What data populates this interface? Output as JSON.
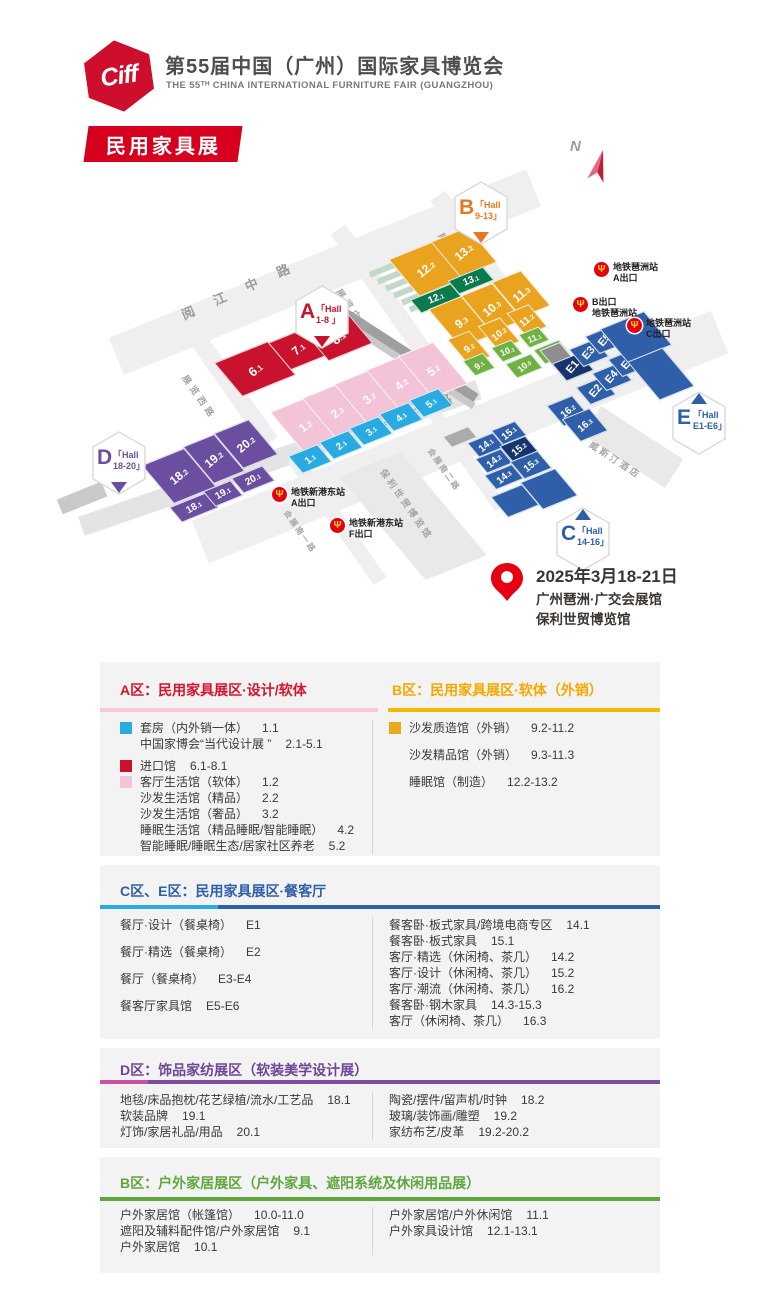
{
  "header": {
    "logo": "Ciff",
    "title": "第55届中国（广州）国际家具博览会",
    "subtitle": "THE 55ᵀᴴ CHINA INTERNATIONAL FURNITURE FAIR (GUANGZHOU)",
    "badge": "民用家具展"
  },
  "map": {
    "north": "N",
    "palette": {
      "yellow": "#E9A31F",
      "dgreen": "#0B7A4D",
      "green": "#6FB145",
      "red": "#C9132E",
      "pink": "#F3C3D8",
      "cyan": "#29ABE2",
      "blue": "#2E5FA8",
      "navy": "#16356F",
      "purple": "#6C4EA1",
      "gray": "#8E8E8E",
      "gray2": "#ABABAB"
    },
    "roads": [
      {
        "x": 100,
        "y": 252,
        "w": 450,
        "h": 40,
        "rot": -22,
        "c": "#EFEFEF"
      },
      {
        "x": 180,
        "y": 414,
        "w": 560,
        "h": 46,
        "rot": -22,
        "c": "#EFEFEF"
      },
      {
        "x": 70,
        "y": 448,
        "w": 420,
        "h": 20,
        "rot": -19,
        "c": "#E4E4E4"
      },
      {
        "x": 168,
        "y": 380,
        "w": 130,
        "h": 18,
        "rot": 55,
        "c": "#EFEFEF"
      },
      {
        "x": 306,
        "y": 282,
        "w": 150,
        "h": 18,
        "rot": 55,
        "c": "#EFEFEF"
      },
      {
        "x": 410,
        "y": 240,
        "w": 130,
        "h": 18,
        "rot": 55,
        "c": "#EFEFEF"
      },
      {
        "x": 406,
        "y": 452,
        "w": 120,
        "h": 13,
        "rot": 55,
        "c": "#EFEFEF"
      },
      {
        "x": 262,
        "y": 512,
        "w": 150,
        "h": 15,
        "rot": 55,
        "c": "#EFEFEF"
      },
      {
        "x": 330,
        "y": 350,
        "w": 158,
        "h": 12,
        "rot": 33,
        "c": "#9F9F9F"
      },
      {
        "x": 336,
        "y": 362,
        "w": 150,
        "h": 7,
        "rot": 33,
        "c": "#C9C9C9"
      },
      {
        "x": 380,
        "y": 452,
        "w": 66,
        "h": 128,
        "rot": -22,
        "skew": 18,
        "c": "#E9E9E7"
      },
      {
        "x": 584,
        "y": 430,
        "w": 98,
        "h": 34,
        "rot": 33,
        "c": "#E9E9E7"
      },
      {
        "x": 58,
        "y": 490,
        "w": 48,
        "h": 16,
        "rot": -22,
        "c": "#C9C9C9"
      }
    ],
    "stairs": {
      "x": 368,
      "y": 262,
      "n": 6,
      "dx": 8,
      "dy": 7,
      "w": 52,
      "h": 6,
      "c": "#C3D9C7",
      "rot": -22
    },
    "road_labels": [
      {
        "t": "阅 江 中 路",
        "x": 178,
        "y": 306,
        "rot": -24,
        "fs": 13,
        "sp": 9,
        "c": "#9B9B9B"
      },
      {
        "t": "新 港 东 路",
        "x": 340,
        "y": 436,
        "rot": -24,
        "fs": 13,
        "sp": 9,
        "c": "#9B9B9B"
      },
      {
        "t": "展览东路",
        "x": 446,
        "y": 230,
        "rot": 55,
        "fs": 9,
        "sp": 4,
        "c": "#A5A5A5"
      },
      {
        "t": "展览中路",
        "x": 344,
        "y": 286,
        "rot": 55,
        "fs": 9,
        "sp": 4,
        "c": "#A5A5A5"
      },
      {
        "t": "展览西路",
        "x": 190,
        "y": 372,
        "rot": 55,
        "fs": 9,
        "sp": 4,
        "c": "#A5A5A5"
      },
      {
        "t": "会展南二路",
        "x": 434,
        "y": 446,
        "rot": 55,
        "fs": 8,
        "sp": 2,
        "c": "#A5A5A5"
      },
      {
        "t": "会展南一路",
        "x": 290,
        "y": 508,
        "rot": 55,
        "fs": 8,
        "sp": 2,
        "c": "#A5A5A5"
      },
      {
        "t": "威斯汀酒店",
        "x": 594,
        "y": 438,
        "rot": 33,
        "fs": 9,
        "sp": 3,
        "c": "#A5A5A5"
      },
      {
        "t": "保利世贸博览馆",
        "x": 388,
        "y": 466,
        "rot": 55,
        "fs": 9,
        "sp": 3,
        "c": "#A5A5A5"
      }
    ],
    "halls": [
      {
        "t": "12.2",
        "c": "yellow",
        "x": 402,
        "y": 246,
        "w": 46,
        "h": 44
      },
      {
        "t": "13.2",
        "c": "yellow",
        "x": 444,
        "y": 230,
        "w": 38,
        "h": 42
      },
      {
        "t": "12.1",
        "c": "dgreen",
        "x": 414,
        "y": 290,
        "w": 42,
        "h": 15,
        "tr": -22,
        "fs": 10
      },
      {
        "t": "13.1",
        "c": "dgreen",
        "x": 452,
        "y": 272,
        "w": 36,
        "h": 15,
        "tr": -22,
        "fs": 10
      },
      {
        "t": "9.3",
        "c": "yellow",
        "x": 443,
        "y": 298,
        "w": 34,
        "h": 46
      },
      {
        "t": "10.3",
        "c": "yellow",
        "x": 475,
        "y": 285,
        "w": 32,
        "h": 44
      },
      {
        "t": "11.3",
        "c": "yellow",
        "x": 505,
        "y": 272,
        "w": 30,
        "h": 42
      },
      {
        "t": "9.2",
        "c": "yellow",
        "x": 457,
        "y": 332,
        "w": 22,
        "h": 30,
        "fs": 10
      },
      {
        "t": "10.2",
        "c": "yellow",
        "x": 487,
        "y": 319,
        "w": 22,
        "h": 28,
        "fs": 10
      },
      {
        "t": "11.2",
        "c": "yellow",
        "x": 515,
        "y": 306,
        "w": 22,
        "h": 26,
        "fs": 10
      },
      {
        "t": "9.1",
        "c": "green",
        "x": 468,
        "y": 355,
        "w": 20,
        "h": 17,
        "fs": 9
      },
      {
        "t": "10.1",
        "c": "green",
        "x": 496,
        "y": 342,
        "w": 20,
        "h": 16,
        "fs": 9,
        "tr": -22
      },
      {
        "t": "11.1",
        "c": "green",
        "x": 523,
        "y": 329,
        "w": 20,
        "h": 15,
        "fs": 9,
        "tr": -22
      },
      {
        "t": "10.0",
        "c": "green",
        "x": 510,
        "y": 357,
        "w": 26,
        "h": 16,
        "fs": 9
      },
      {
        "t": "11.0",
        "c": "green",
        "x": 538,
        "y": 343,
        "w": 26,
        "h": 16,
        "fs": 9
      },
      {
        "t": "6.1",
        "c": "red",
        "x": 226,
        "y": 348,
        "w": 56,
        "h": 40,
        "fs": 13
      },
      {
        "t": "7.1",
        "c": "red",
        "x": 278,
        "y": 332,
        "w": 38,
        "h": 32,
        "fs": 12
      },
      {
        "t": "8.1",
        "c": "red",
        "x": 314,
        "y": 318,
        "w": 46,
        "h": 36,
        "fs": 13
      },
      {
        "t": "1.2",
        "c": "pink",
        "x": 286,
        "y": 400,
        "w": 36,
        "h": 50
      },
      {
        "t": "2.2",
        "c": "pink",
        "x": 318,
        "y": 386,
        "w": 36,
        "h": 50
      },
      {
        "t": "3.2",
        "c": "pink",
        "x": 350,
        "y": 372,
        "w": 36,
        "h": 50
      },
      {
        "t": "4.2",
        "c": "pink",
        "x": 382,
        "y": 358,
        "w": 36,
        "h": 50
      },
      {
        "t": "5.2",
        "c": "pink",
        "x": 414,
        "y": 344,
        "w": 36,
        "h": 50
      },
      {
        "t": "1.1",
        "c": "cyan",
        "x": 294,
        "y": 448,
        "w": 30,
        "h": 20,
        "fs": 10
      },
      {
        "t": "2.1",
        "c": "cyan",
        "x": 325,
        "y": 434,
        "w": 30,
        "h": 20,
        "fs": 10
      },
      {
        "t": "3.1",
        "c": "cyan",
        "x": 355,
        "y": 420,
        "w": 30,
        "h": 20,
        "fs": 10
      },
      {
        "t": "4.1",
        "c": "cyan",
        "x": 385,
        "y": 406,
        "w": 30,
        "h": 20,
        "fs": 10
      },
      {
        "t": "5.1",
        "c": "cyan",
        "x": 415,
        "y": 392,
        "w": 30,
        "h": 20,
        "fs": 10
      },
      {
        "t": "18.2",
        "c": "purple",
        "x": 156,
        "y": 452,
        "w": 44,
        "h": 46
      },
      {
        "t": "19.2",
        "c": "purple",
        "x": 197,
        "y": 436,
        "w": 32,
        "h": 44
      },
      {
        "t": "20.2",
        "c": "purple",
        "x": 227,
        "y": 422,
        "w": 36,
        "h": 42
      },
      {
        "t": "18.1",
        "c": "purple",
        "x": 174,
        "y": 498,
        "w": 38,
        "h": 17,
        "tr": -30,
        "fs": 10
      },
      {
        "t": "19.1",
        "c": "purple",
        "x": 208,
        "y": 484,
        "w": 28,
        "h": 17,
        "tr": -30,
        "fs": 10
      },
      {
        "t": "20.1",
        "c": "purple",
        "x": 236,
        "y": 470,
        "w": 32,
        "h": 17,
        "tr": -30,
        "fs": 10
      },
      {
        "t": "",
        "c": "gray",
        "x": 546,
        "y": 344,
        "w": 20,
        "h": 20
      },
      {
        "t": "",
        "c": "gray2",
        "x": 446,
        "y": 430,
        "w": 26,
        "h": 12
      },
      {
        "t": "E1",
        "c": "navy",
        "x": 558,
        "y": 356,
        "w": 28,
        "h": 20,
        "tr": -50,
        "fs": 11
      },
      {
        "t": "E3",
        "c": "blue",
        "x": 575,
        "y": 342,
        "w": 26,
        "h": 20,
        "tr": -50,
        "fs": 11
      },
      {
        "t": "E5",
        "c": "blue",
        "x": 591,
        "y": 329,
        "w": 26,
        "h": 20,
        "tr": -50,
        "fs": 11
      },
      {
        "t": "E2",
        "c": "blue",
        "x": 582,
        "y": 380,
        "w": 26,
        "h": 20,
        "tr": -50,
        "fs": 11
      },
      {
        "t": "E4",
        "c": "blue",
        "x": 598,
        "y": 366,
        "w": 26,
        "h": 20,
        "tr": -50,
        "fs": 11
      },
      {
        "t": "E6",
        "c": "blue",
        "x": 614,
        "y": 352,
        "w": 26,
        "h": 20,
        "tr": -50,
        "fs": 11
      },
      {
        "t": "",
        "c": "blue",
        "x": 612,
        "y": 316,
        "w": 46,
        "h": 40
      },
      {
        "t": "",
        "c": "blue",
        "x": 642,
        "y": 350,
        "w": 36,
        "h": 46
      },
      {
        "t": "16.2",
        "c": "blue",
        "x": 554,
        "y": 398,
        "w": 26,
        "h": 24,
        "fs": 10
      },
      {
        "t": "16.3",
        "c": "blue",
        "x": 570,
        "y": 411,
        "w": 28,
        "h": 26,
        "fs": 10
      },
      {
        "t": "14.1",
        "c": "blue",
        "x": 472,
        "y": 436,
        "w": 26,
        "h": 16,
        "fs": 10
      },
      {
        "t": "15.1",
        "c": "blue",
        "x": 496,
        "y": 424,
        "w": 24,
        "h": 16,
        "fs": 10
      },
      {
        "t": "14.2",
        "c": "blue",
        "x": 480,
        "y": 452,
        "w": 26,
        "h": 16,
        "fs": 10
      },
      {
        "t": "15.2",
        "c": "navy",
        "x": 505,
        "y": 439,
        "w": 26,
        "h": 18,
        "fs": 10
      },
      {
        "t": "14.3",
        "c": "blue",
        "x": 489,
        "y": 468,
        "w": 28,
        "h": 16,
        "fs": 10
      },
      {
        "t": "15.3",
        "c": "blue",
        "x": 516,
        "y": 454,
        "w": 28,
        "h": 20,
        "fs": 10
      },
      {
        "t": "",
        "c": "blue",
        "x": 498,
        "y": 488,
        "w": 32,
        "h": 24
      },
      {
        "t": "",
        "c": "blue",
        "x": 530,
        "y": 472,
        "w": 36,
        "h": 32
      }
    ],
    "badges": [
      {
        "letter": "B",
        "l1": "「Hall",
        "l2": "9-13」",
        "c": "#E87722",
        "x": 452,
        "y": 180,
        "tri": "bottom"
      },
      {
        "letter": "A",
        "l1": "「Hall",
        "l2": "1-8 」",
        "c": "#C9132E",
        "x": 293,
        "y": 284,
        "tri": "bottom"
      },
      {
        "letter": "D",
        "l1": "「Hall",
        "l2": "18-20」",
        "c": "#6C4EA1",
        "x": 90,
        "y": 430,
        "tri": "bottom"
      },
      {
        "letter": "E",
        "l1": "「Hall",
        "l2": "E1-E6」",
        "c": "#2E5FA8",
        "x": 670,
        "y": 390,
        "tri": "top"
      },
      {
        "letter": "C",
        "l1": "「Hall",
        "l2": "14-16」",
        "c": "#2E5FA8",
        "x": 554,
        "y": 506,
        "tri": "top"
      }
    ],
    "metros": [
      {
        "x": 594,
        "y": 262,
        "l1": "地铁琶洲站",
        "l2": "A出口"
      },
      {
        "x": 573,
        "y": 297,
        "l1": "B出口",
        "l2": "地铁琶洲站"
      },
      {
        "x": 627,
        "y": 318,
        "l1": "地铁琶洲站",
        "l2": "C出口"
      },
      {
        "x": 272,
        "y": 487,
        "l1": "地铁新港东站",
        "l2": "A出口"
      },
      {
        "x": 330,
        "y": 518,
        "l1": "地铁新港东站",
        "l2": "F出口"
      }
    ],
    "venue": {
      "date": "2025年3月18-21日",
      "addr1": "广州琶洲·广交会展馆",
      "addr2": "保利世贸博览馆"
    }
  },
  "sections": [
    {
      "h": 194,
      "titles": [
        {
          "t": "A区：民用家具展区·设计/软体",
          "color": "#D7142C",
          "x": 20
        },
        {
          "t": "B区：民用家具展区·软体（外销）",
          "color": "#F5A800",
          "x": 292
        }
      ],
      "bar": [
        {
          "x": 0,
          "w": 278,
          "c": "#F6C8DC"
        },
        {
          "x": 288,
          "w": 272,
          "c": "#F5B800"
        }
      ],
      "cols": [
        {
          "items": [
            {
              "sw": "#29ABE2",
              "t": "套房（内外销一体）",
              "n": "1.1"
            },
            {
              "ind": 1,
              "t": "中国家博会“当代设计展 ”",
              "n": "2.1-5.1"
            },
            {
              "sw": "#C9132E",
              "t": "进口馆",
              "n": "6.1-8.1",
              "g": 1
            },
            {
              "sw": "#F3C3D8",
              "t": "客厅生活馆（软体）",
              "n": "1.2"
            },
            {
              "ind": 1,
              "t": "沙发生活馆（精品）",
              "n": "2.2"
            },
            {
              "ind": 1,
              "t": "沙发生活馆（奢品）",
              "n": "3.2"
            },
            {
              "ind": 1,
              "t": "睡眠生活馆（精品睡眠/智能睡眠）",
              "n": "4.2"
            },
            {
              "ind": 1,
              "t": "智能睡眠/睡眠生态/居家社区养老",
              "n": "5.2"
            }
          ]
        },
        {
          "items": [
            {
              "sw": "#E9A820",
              "t": "沙发质造馆（外销）",
              "n": "9.2-11.2"
            },
            {
              "ind": 1,
              "t": "沙发精品馆（外销）",
              "n": "9.3-11.3",
              "g": 2
            },
            {
              "ind": 1,
              "t": "睡眠馆（制造）",
              "n": "12.2-13.2",
              "g": 2
            }
          ]
        }
      ]
    },
    {
      "h": 174,
      "titles": [
        {
          "t": "C区、E区：民用家具展区·餐客厅",
          "color": "#2E5FA8",
          "x": 20
        }
      ],
      "bar": [
        {
          "x": 0,
          "w": 118,
          "c": "#29ABE2"
        },
        {
          "x": 118,
          "w": 442,
          "c": "#2E5FA8"
        }
      ],
      "cols": [
        {
          "items": [
            {
              "t": "餐厅·设计（餐桌椅）",
              "n": "E1"
            },
            {
              "t": "餐厅·精选（餐桌椅）",
              "n": "E2",
              "g": 2
            },
            {
              "t": "餐厅（餐桌椅）",
              "n": "E3-E4",
              "g": 2
            },
            {
              "t": "餐客厅家具馆",
              "n": "E5-E6",
              "g": 2
            }
          ]
        },
        {
          "items": [
            {
              "t": "餐客卧·板式家具/跨境电商专区",
              "n": "14.1"
            },
            {
              "t": "餐客卧·板式家具",
              "n": "15.1"
            },
            {
              "t": "客厅·精选（休闲椅、茶几）",
              "n": "14.2"
            },
            {
              "t": "客厅·设计（休闲椅、茶几）",
              "n": "15.2"
            },
            {
              "t": "客厅·潮流（休闲椅、茶几）",
              "n": "16.2"
            },
            {
              "t": "餐客卧·钢木家具",
              "n": "14.3-15.3"
            },
            {
              "t": "客厅（休闲椅、茶几）",
              "n": "16.3"
            }
          ]
        }
      ]
    },
    {
      "h": 100,
      "titles": [
        {
          "t": "D区：饰品家纺展区（软装美学设计展）",
          "color": "#6F4595",
          "x": 20
        }
      ],
      "bar": [
        {
          "x": 0,
          "w": 48,
          "c": "#C9519E"
        },
        {
          "x": 48,
          "w": 512,
          "c": "#7C4DA0"
        }
      ],
      "cols": [
        {
          "items": [
            {
              "t": "地毯/床品抱枕/花艺绿植/流水/工艺品",
              "n": "18.1"
            },
            {
              "t": "软装品牌",
              "n": "19.1"
            },
            {
              "t": "灯饰/家居礼品/用品",
              "n": "20.1"
            }
          ]
        },
        {
          "items": [
            {
              "t": "陶瓷/摆件/留声机/时钟",
              "n": "18.2"
            },
            {
              "t": "玻璃/装饰画/雕塑",
              "n": "19.2"
            },
            {
              "t": "家纺布艺/皮革",
              "n": "19.2-20.2"
            }
          ]
        }
      ]
    },
    {
      "h": 116,
      "titles": [
        {
          "t": "B区：户外家居展区（户外家具、遮阳系统及休闲用品展）",
          "color": "#5FA73C",
          "x": 20
        }
      ],
      "bar": [
        {
          "x": 0,
          "w": 560,
          "c": "#5FA73C"
        }
      ],
      "cols": [
        {
          "items": [
            {
              "t": "户外家居馆（帐篷馆）",
              "n": "10.0-11.0"
            },
            {
              "t": "遮阳及辅料配件馆/户外家居馆",
              "n": "9.1"
            },
            {
              "t": "户外家居馆",
              "n": "10.1"
            }
          ]
        },
        {
          "items": [
            {
              "t": "户外家居馆/户外休闲馆",
              "n": "11.1"
            },
            {
              "t": "户外家具设计馆",
              "n": "12.1-13.1"
            }
          ]
        }
      ]
    }
  ]
}
